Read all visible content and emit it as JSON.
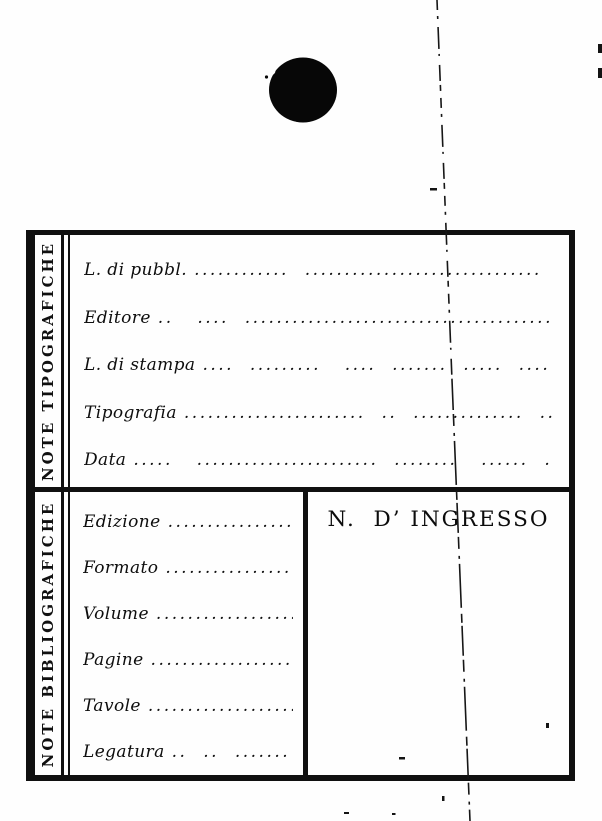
{
  "page": {
    "background_color": "#fefefe",
    "ink_color": "#101010"
  },
  "form": {
    "sections": [
      {
        "side_label": "NOTE TIPOGRAFICHE",
        "fields": [
          {
            "label": "L. di pubbl.",
            "dots": "............  ..............................  ...."
          },
          {
            "label": "Editore",
            "dots": "..   ....  ........................................"
          },
          {
            "label": "L. di stampa",
            "dots": "....  .........   ....  .......  .....  ....  ....."
          },
          {
            "label": "Tipografia",
            "dots": ".......................  ..  ..............  ..  .."
          },
          {
            "label": "Data",
            "dots": ".....   .......................  ........   ......  ........  ...."
          }
        ]
      },
      {
        "side_label": "NOTE BIBLIOGRAFICHE",
        "ingresso_label": "N.  D’ INGRESSO",
        "fields": [
          {
            "label": "Edizione",
            "dots": "......................"
          },
          {
            "label": "Formato",
            "dots": "....................."
          },
          {
            "label": "Volume",
            "dots": "......................"
          },
          {
            "label": "Pagine",
            "dots": "....................."
          },
          {
            "label": "Tavole",
            "dots": "....................."
          },
          {
            "label": "Legatura",
            "dots": "..  ..  .......    ....."
          }
        ]
      }
    ]
  }
}
